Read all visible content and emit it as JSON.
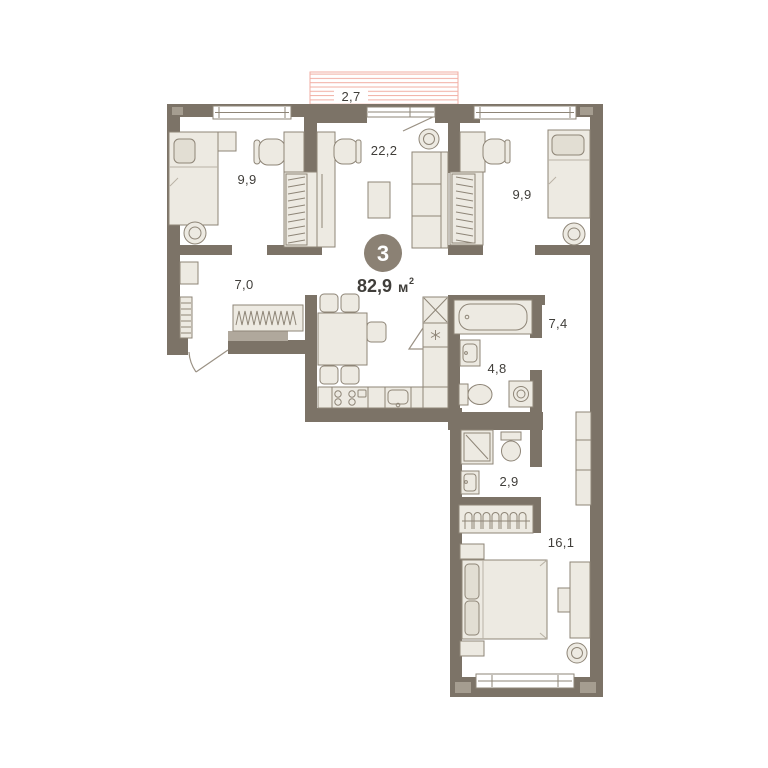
{
  "plan_card": {
    "room_count_badge": "3",
    "total_area": {
      "value": "82,9",
      "unit": "м",
      "sup": "2"
    },
    "room_labels": {
      "balcony": "2,7",
      "living_room": "22,2",
      "bedroom_left": "9,9",
      "bedroom_right": "9,9",
      "hallway": "7,0",
      "corridor": "7,4",
      "bathroom": "4,8",
      "wc": "2,9",
      "master_bedroom": "16,1"
    },
    "colors": {
      "wall": "#7c7367",
      "wall-accent": "#a59d90",
      "furn-fill": "#edeae2",
      "furn-dark": "#e2ded3",
      "furn-stroke": "#8e8577",
      "hatch": "#f1aea3",
      "badge": "#8b8174",
      "text": "#403e3a",
      "bench": "#b0a89c",
      "door": "#9a9184"
    }
  }
}
